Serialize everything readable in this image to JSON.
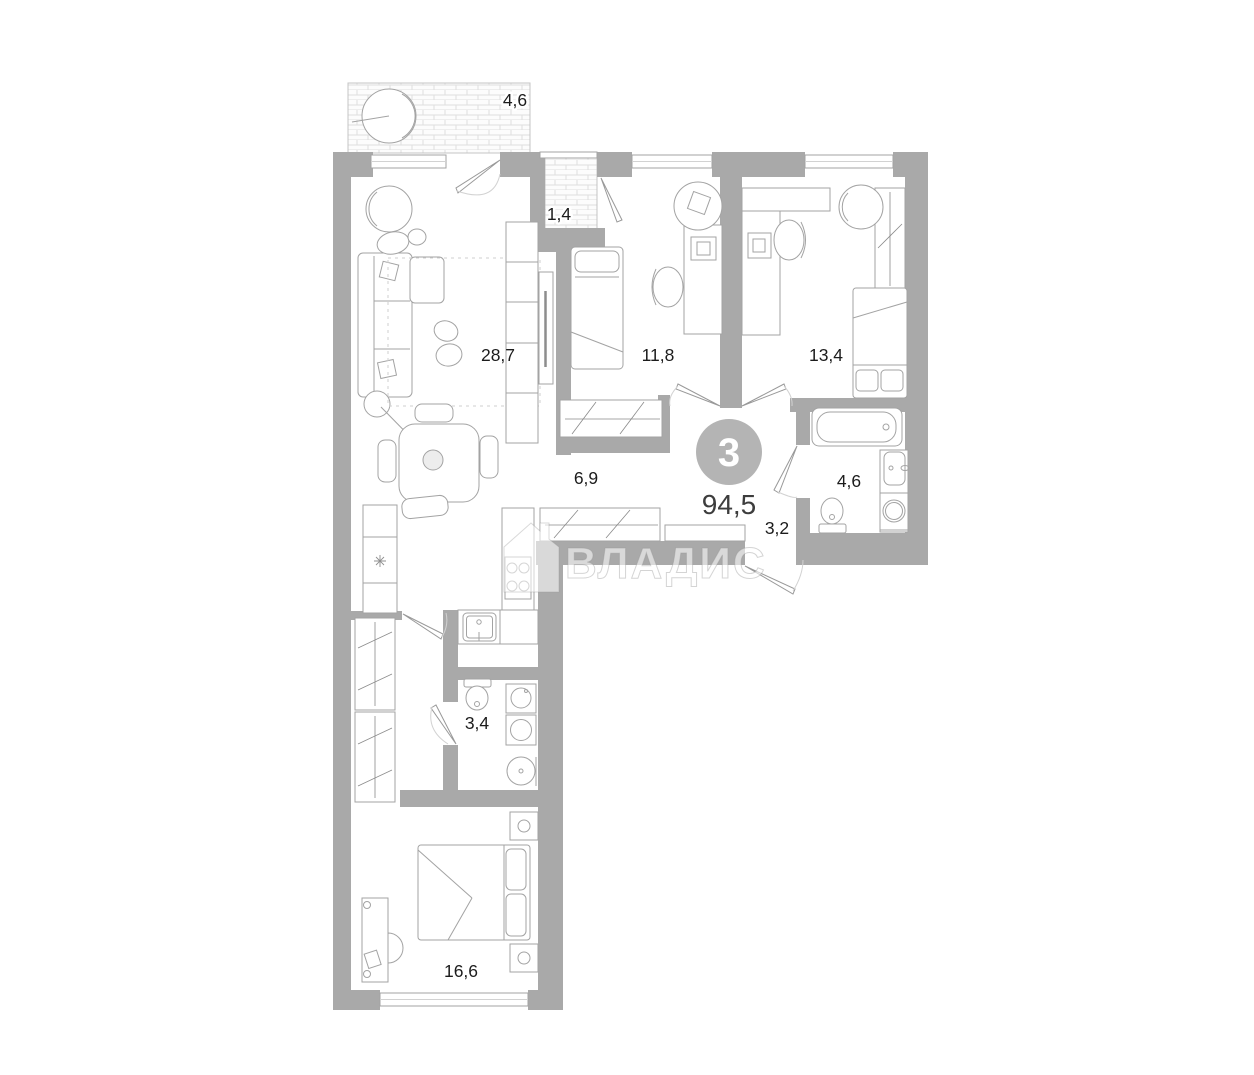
{
  "plan": {
    "badge": {
      "room_count": "3",
      "total_area": "94,5"
    },
    "watermark_text": "ВЛАДИС",
    "labels": {
      "balcony": "4,6",
      "loggia": "1,4",
      "living_room": "28,7",
      "bedroom_1": "11,8",
      "bedroom_2": "13,4",
      "hallway": "6,9",
      "bathroom_main": "4,6",
      "entry_hall": "3,2",
      "bathroom_2": "3,4",
      "bedroom_master": "16,6"
    },
    "icons": {
      "fridge": "snowflake-icon",
      "brand": "house-icon",
      "badge_shape": "circle"
    },
    "colors": {
      "wall": "#a9a9a9",
      "badge_circle": "#b4b4b4",
      "label_text": "#1c1c1c",
      "furniture_line": "#a3a3a3",
      "floor_hatch": "#dedede",
      "watermark": "#c9c9c9"
    }
  }
}
